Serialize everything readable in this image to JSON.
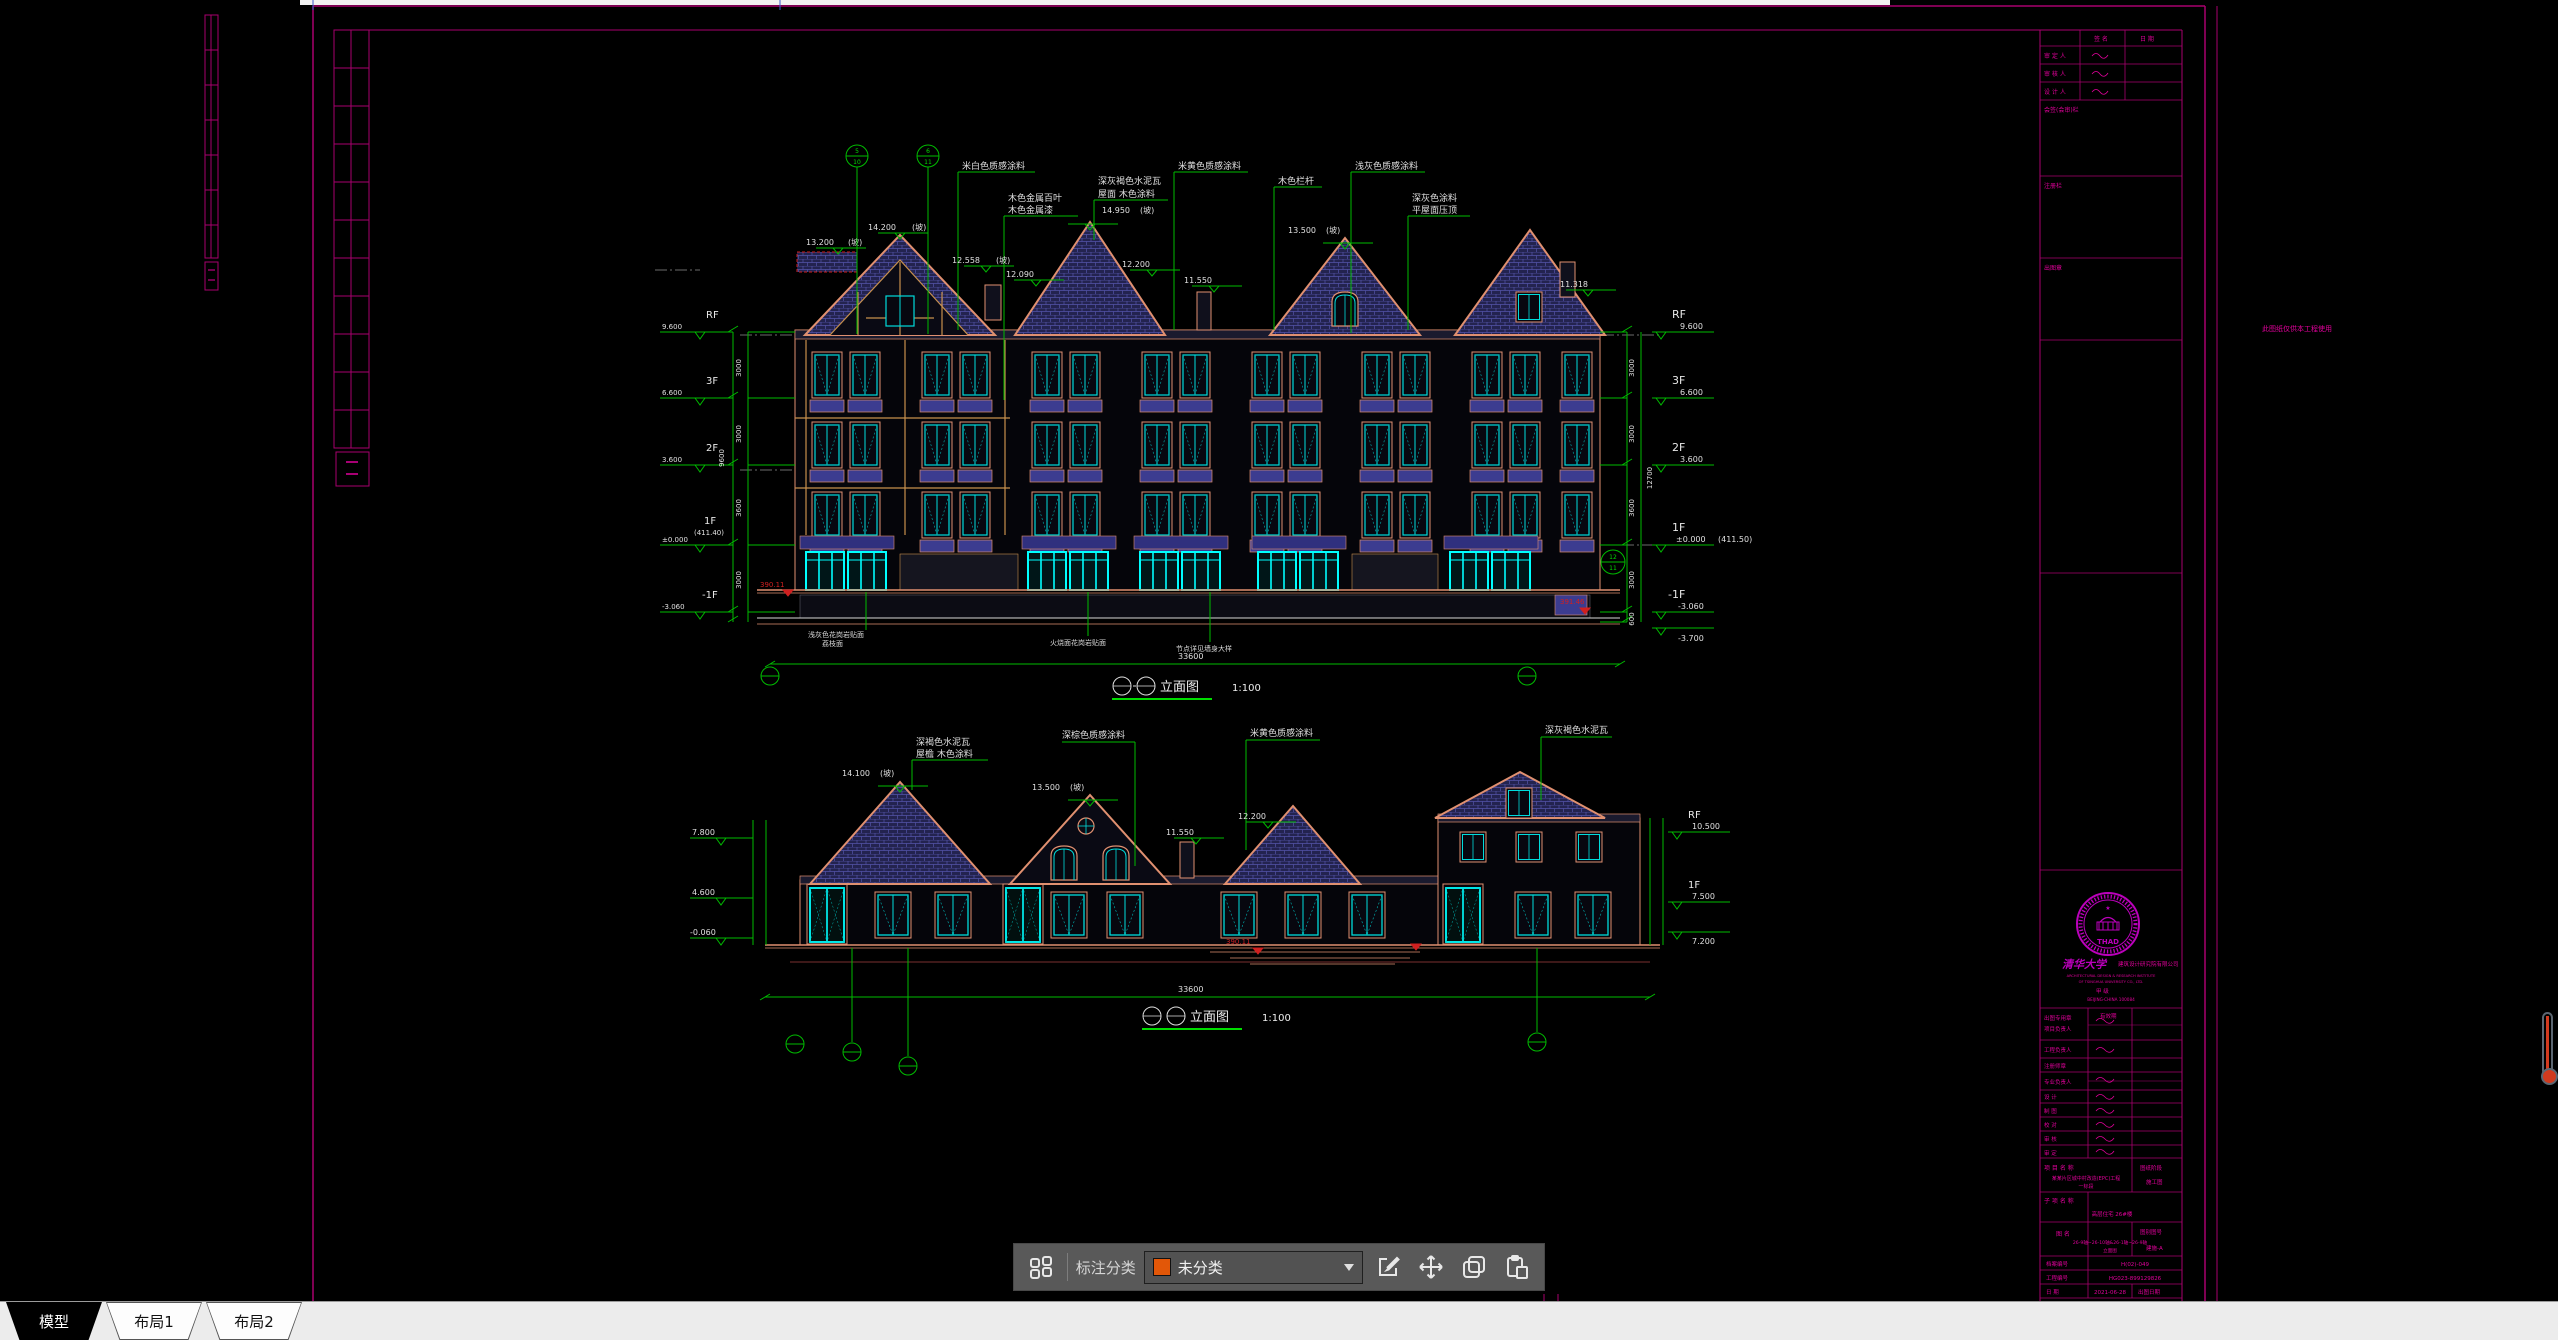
{
  "tabs": {
    "items": [
      {
        "label": "模型",
        "active": true
      },
      {
        "label": "布局1",
        "active": false
      },
      {
        "label": "布局2",
        "active": false
      }
    ]
  },
  "toolbar": {
    "category_label": "标注分类",
    "dropdown_value": "未分类",
    "swatch_color": "#e25708",
    "icons": [
      "blocks-grid",
      "edit",
      "move",
      "copy",
      "paste"
    ]
  },
  "colors": {
    "frame_magenta": "#a8006e",
    "annotation_green": "#00bb00",
    "window_cyan": "#00dcdc",
    "seal_magenta": "#bb00bb",
    "ground_red": "#d02020"
  },
  "frame_note": "此图纸仅供本工程使用",
  "title_block": {
    "sign_header": {
      "c1": "签  名",
      "c2": "日  期"
    },
    "sign_rows": [
      "审 定 人",
      "审 核 人",
      "设 计 人"
    ],
    "sections": [
      "会签(会审)栏",
      "注册栏",
      "出图章"
    ],
    "seal": {
      "center_abbr": "THAD",
      "org_cn": "清华大学",
      "org2": "建筑设计研究院有限公司",
      "en1": "ARCHITECTURAL DESIGN & RESEARCH INSTITUTE",
      "en2": "OF TSINGHUA UNIVERSITY CO., LTD.",
      "grade": "甲 级",
      "city": "BEIJING·CHINA 100084"
    },
    "stamp_row": {
      "label": "出图专用章",
      "field": "有效期"
    },
    "personnel": [
      "项目负责人",
      "工程负责人",
      "注册师章",
      "专业负责人",
      "设  计",
      "制  图",
      "校  对",
      "审  核",
      "审  定"
    ],
    "project": {
      "label": "项 目 名 称",
      "value1": "某某片区城中村改造(EPC)工程",
      "value2": "一标段",
      "stage_label": "图纸阶段",
      "stage_value": "施工图"
    },
    "sub_project": {
      "label": "子 项 名 称",
      "value": "高层住宅 26#楼"
    },
    "drawing_name": {
      "label": "图  名",
      "value1": "26-9轴~26-10轴&26-1轴~26-9轴",
      "value2": "立面图",
      "no_label": "图别图号",
      "no_value": "建施-A"
    },
    "archive": {
      "label": "档案编号",
      "value": "H(02)-049"
    },
    "project_no": {
      "label": "工程编号",
      "value": "HG023-899129826"
    },
    "date": {
      "label": "日  期",
      "value": "2021-06-28",
      "right_label": "出图日期"
    }
  },
  "top_drawing": {
    "title": "立面图",
    "scale": "1:100",
    "total_dim": "33600",
    "floors": [
      {
        "label": "RF",
        "elev": "9.600"
      },
      {
        "label": "3F",
        "elev": "6.600"
      },
      {
        "label": "2F",
        "elev": "3.600"
      },
      {
        "label": "1F",
        "elev": "±0.000",
        "note": "(411.50)"
      },
      {
        "label": "-1F",
        "elev": "-3.060"
      }
    ],
    "extra_elev": "-3.700",
    "left_note": "(411.40)",
    "dims": {
      "d1": "3000",
      "d2": "3000",
      "d3": "3600",
      "d4": "3000",
      "d5": "600",
      "total_r": "12700",
      "total_l": "9600"
    },
    "marks": {
      "m1": "13.200",
      "m1s": "(坡)",
      "m2": "14.200",
      "m2s": "(坡)",
      "m3": "12.558",
      "m3s": "(坡)",
      "m4": "12.090",
      "m5": "14.950",
      "m5s": "(坡)",
      "m6": "12.200",
      "m7": "11.550",
      "m8": "13.500",
      "m8s": "(坡)",
      "m9": "11.318"
    },
    "ann": {
      "a1": "米白色质感涂料",
      "a2l1": "木色金属百叶",
      "a2l2": "木色金属漆",
      "a3l1": "深灰褐色水泥瓦",
      "a3l2": "屋面 木色涂料",
      "a4": "米黄色质感涂料",
      "a5": "木色栏杆",
      "a6": "浅灰色质感涂料",
      "a7l1": "深灰色涂料",
      "a7l2": "平屋面压顶"
    },
    "ground_marks": {
      "left": "390.11",
      "right": "391.46"
    },
    "notes": {
      "n1l1": "浅灰色花岗岩贴面",
      "n1l2": "荔枝面",
      "n2": "火烧面花岗岩贴面",
      "n3": "节点详见墙身大样"
    },
    "axis": {
      "b1t": "5",
      "b1b": "10",
      "b2t": "6",
      "b2b": "11",
      "b3t": "12",
      "b3b": "11"
    }
  },
  "bottom_drawing": {
    "title": "立面图",
    "scale": "1:100",
    "total_dim": "33600",
    "marks": {
      "m1": "14.100",
      "m1s": "(坡)",
      "m2": "13.500",
      "m2s": "(坡)",
      "m3": "11.550",
      "m4": "12.200"
    },
    "ann": {
      "a1l1": "深褐色水泥瓦",
      "a1l2": "屋檐 木色涂料",
      "a2": "深棕色质感涂料",
      "a3": "米黄色质感涂料",
      "a4": "深灰褐色水泥瓦"
    },
    "left_marks": {
      "l1": "7.800",
      "l2": "4.600",
      "l3": "-0.060"
    },
    "right_marks": {
      "r1l": "RF",
      "r1": "10.500",
      "r2l": "1F",
      "r2": "7.500",
      "r3": "7.200"
    },
    "ground_marks": {
      "left": "390.11",
      "right": "391.46"
    }
  }
}
